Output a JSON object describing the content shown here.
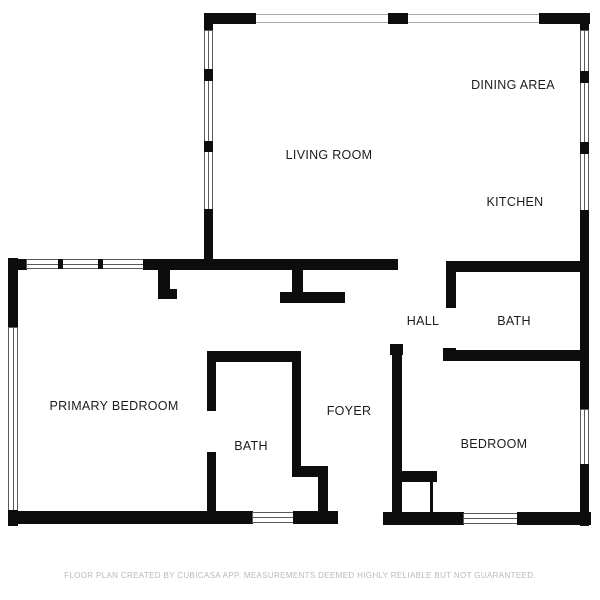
{
  "title": "Floor plan",
  "rooms": {
    "living_room": {
      "label": "LIVING ROOM"
    },
    "dining_area": {
      "label": "DINING AREA"
    },
    "kitchen": {
      "label": "KITCHEN"
    },
    "hall": {
      "label": "HALL"
    },
    "bath_right": {
      "label": "BATH"
    },
    "primary_bedroom": {
      "label": "PRIMARY BEDROOM"
    },
    "bath_center": {
      "label": "BATH"
    },
    "foyer": {
      "label": "FOYER"
    },
    "bedroom": {
      "label": "BEDROOM"
    }
  },
  "footer": {
    "disclaimer": "FLOOR PLAN CREATED BY CUBICASA APP. MEASUREMENTS DEEMED HIGHLY RELIABLE BUT NOT GUARANTEED."
  },
  "colors": {
    "wall": "#0d0d0d",
    "background": "#ffffff",
    "label_text": "#1c1c1c",
    "footer_text": "#b9b9b9",
    "window_outline": "#5a5a5a",
    "opening_outline": "#a8a8a8"
  }
}
